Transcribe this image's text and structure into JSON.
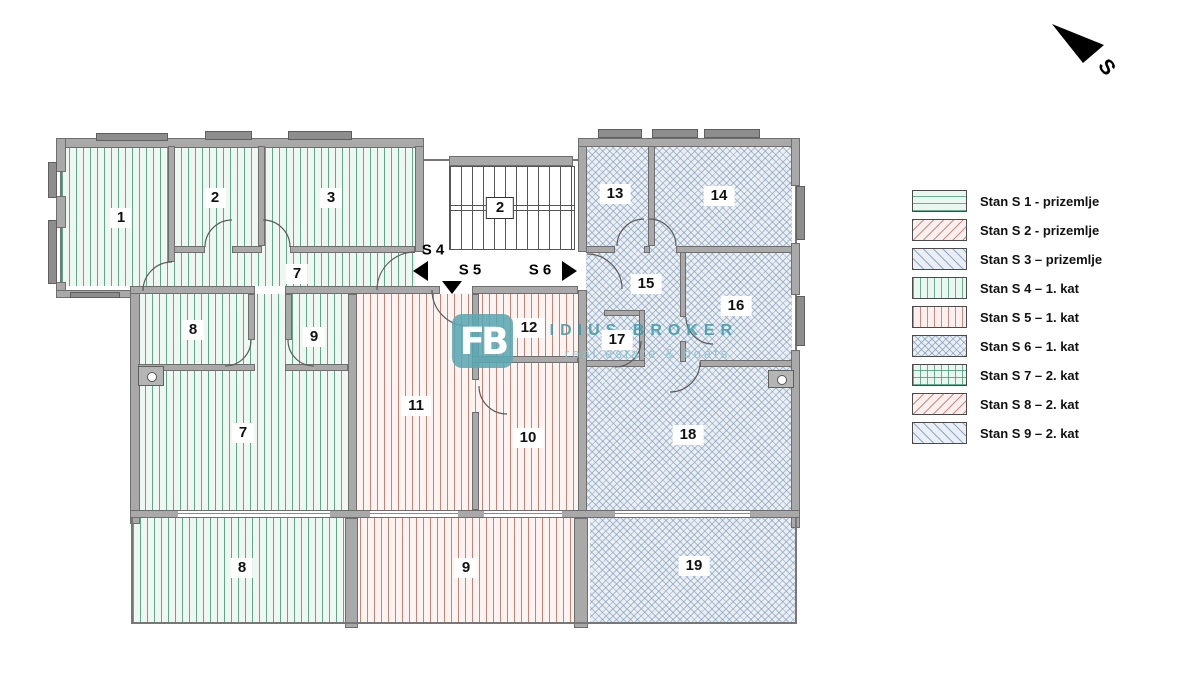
{
  "plan": {
    "north": {
      "label": "S"
    },
    "staircase": {
      "number": "2"
    },
    "direction_markers": [
      {
        "label": "S 4",
        "direction": "left"
      },
      {
        "label": "S 5",
        "direction": "down"
      },
      {
        "label": "S 6",
        "direction": "right"
      }
    ],
    "rooms": [
      {
        "number": "1",
        "stan": "S 4"
      },
      {
        "number": "2",
        "stan": "S 4"
      },
      {
        "number": "3",
        "stan": "S 4"
      },
      {
        "number": "7",
        "stan": "S 4"
      },
      {
        "number": "8",
        "stan": "S 4"
      },
      {
        "number": "9",
        "stan": "S 4"
      },
      {
        "number": "7",
        "stan": "S 4"
      },
      {
        "number": "8",
        "stan": "S 4"
      },
      {
        "number": "11",
        "stan": "S 5"
      },
      {
        "number": "12",
        "stan": "S 5"
      },
      {
        "number": "10",
        "stan": "S 5"
      },
      {
        "number": "9",
        "stan": "S 5"
      },
      {
        "number": "13",
        "stan": "S 6"
      },
      {
        "number": "14",
        "stan": "S 6"
      },
      {
        "number": "15",
        "stan": "S 6"
      },
      {
        "number": "16",
        "stan": "S 6"
      },
      {
        "number": "17",
        "stan": "S 6"
      },
      {
        "number": "18",
        "stan": "S 6"
      },
      {
        "number": "19",
        "stan": "S 6"
      }
    ],
    "watermark": {
      "logo": "FB",
      "title": "FIDIUS BROKER",
      "subtitle": "real estate & boats"
    }
  },
  "legend": {
    "items": [
      {
        "label": "Stan S 1 - prizemlje",
        "pattern": "green-horizontal"
      },
      {
        "label": "Stan S 2 - prizemlje",
        "pattern": "red-diagonal"
      },
      {
        "label": "Stan S 3 – prizemlje",
        "pattern": "blue-diagonal"
      },
      {
        "label": "Stan S 4 – 1. kat",
        "pattern": "green-vertical"
      },
      {
        "label": "Stan S 5 – 1. kat",
        "pattern": "red-vertical"
      },
      {
        "label": "Stan S 6 – 1. kat",
        "pattern": "blue-crosshatch"
      },
      {
        "label": "Stan S 7 – 2. kat",
        "pattern": "green-grid"
      },
      {
        "label": "Stan S 8 – 2. kat",
        "pattern": "red-diagonal"
      },
      {
        "label": "Stan S 9 – 2. kat",
        "pattern": "blue-diagonal"
      }
    ]
  },
  "colors": {
    "green_hatch": "#3a9472",
    "red_hatch": "#bc6458",
    "blue_hatch": "#8098b2",
    "wall_gray": "#a9a9a9",
    "watermark_teal": "#3a9aa8"
  }
}
